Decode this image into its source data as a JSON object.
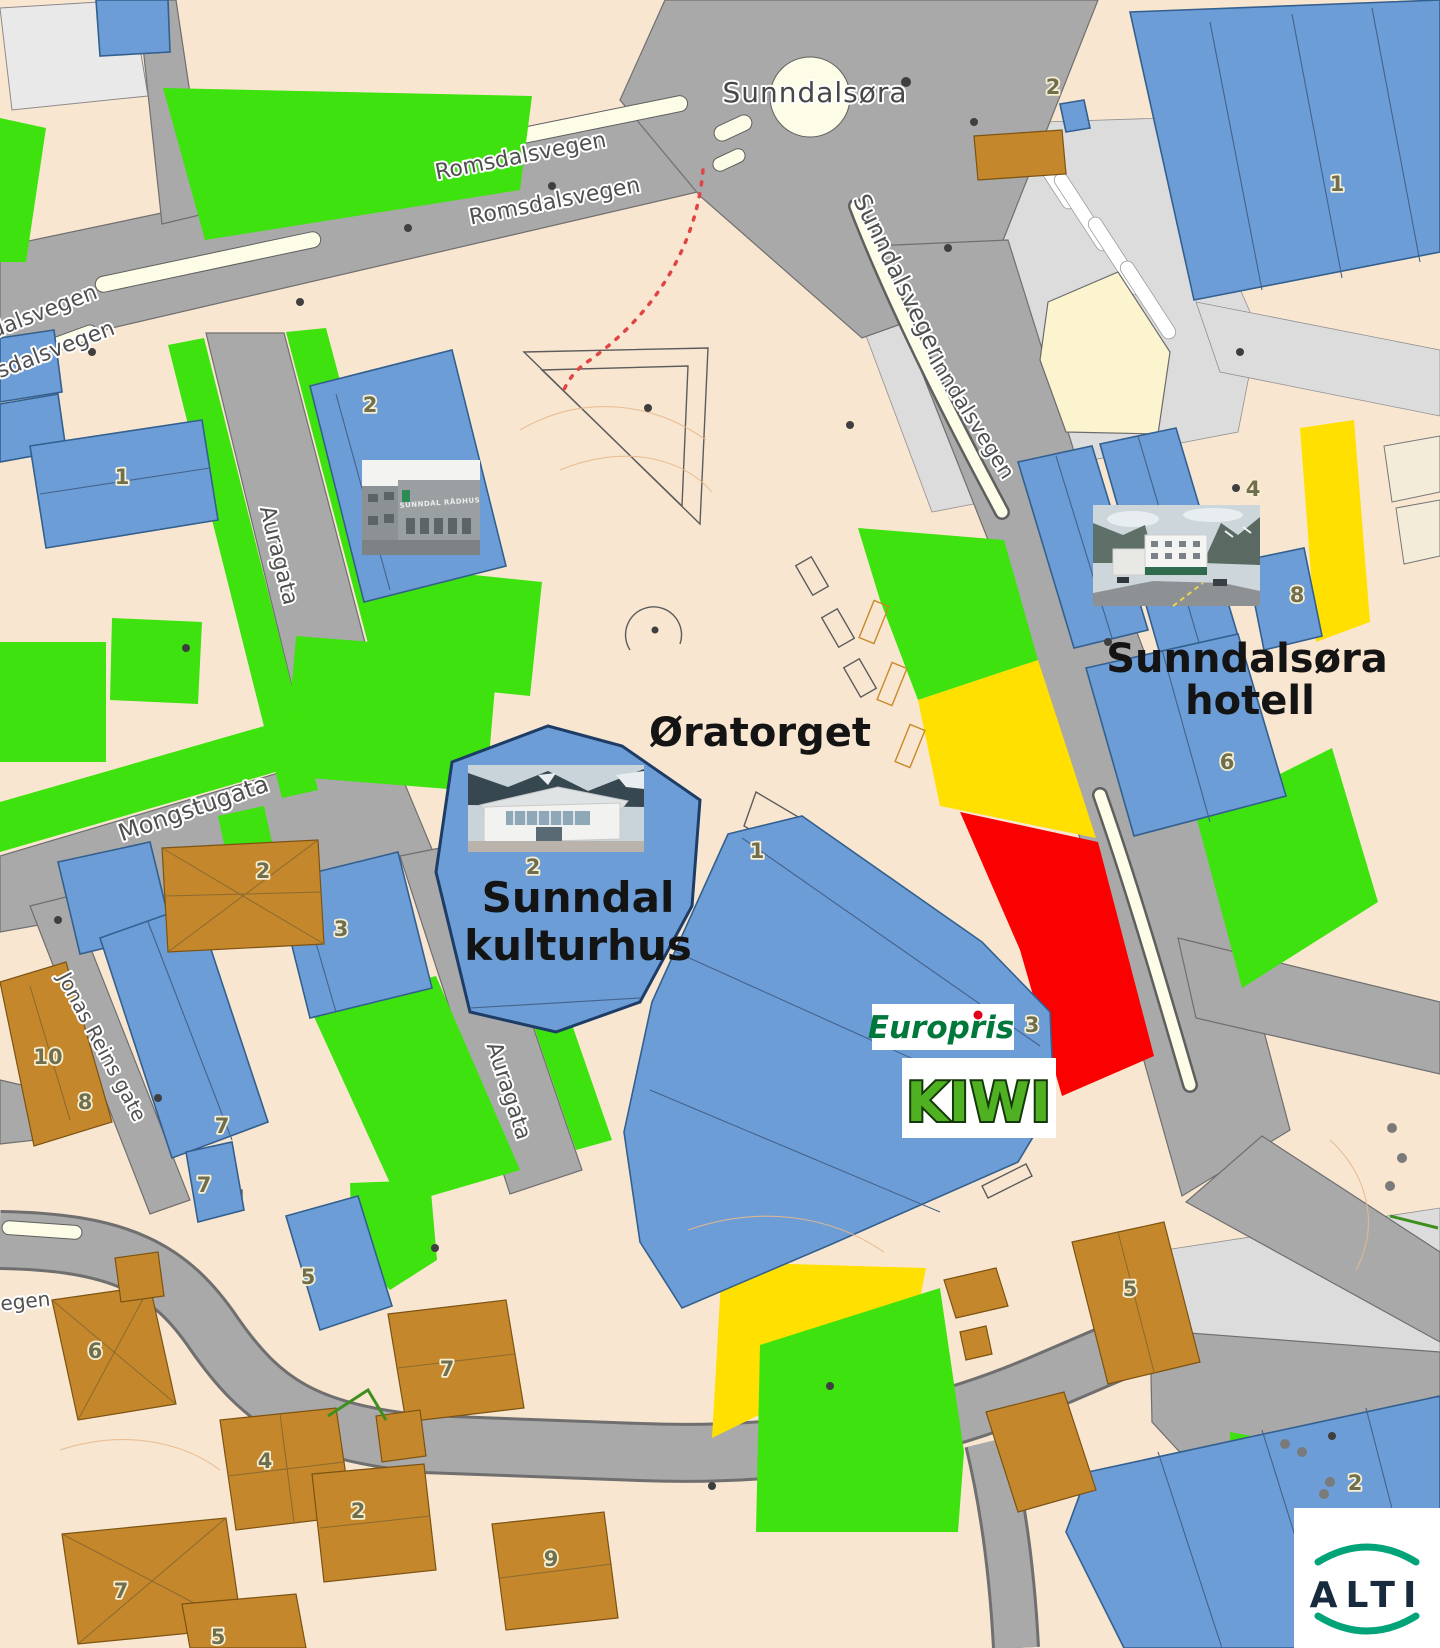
{
  "colors": {
    "land": "#f9e6d1",
    "road": "#a9a9a9",
    "road_light": "#dcdcdc",
    "median": "#fdfce6",
    "building_blue": "#6d9dd6",
    "building_blue_outline": "#33608f",
    "building_tan": "#c5872b",
    "building_pale": "#fbf4cf",
    "zone_green": "#3ee20e",
    "zone_yellow": "#ffe000",
    "zone_red": "#fb0000",
    "europris_green": "#00783b",
    "kiwi_green": "#4fb022",
    "alti_navy": "#182a3d",
    "alti_arc": "#00a478"
  },
  "place": {
    "label": "Sunndalsøra"
  },
  "streets": {
    "romsdalsvegen_a": "Romsdalsvegen",
    "romsdalsvegen_b": "Romsdalsvegen",
    "romsdalsvegen_partial_a": "dalsvegen",
    "romsdalsvegen_partial_b": "sdalsvegen",
    "sunndalsvegen": "Sunndalsvegen",
    "inndalsvegen": "Inndalsvegen",
    "sunndal_radhus": "Sunndal Rådhus",
    "auragata_a": "Auragata",
    "auragata_b": "Auragata",
    "mongstugata": "Mongstugata",
    "jonas_reins_gate": "Jonas Reins gate",
    "vegen_partial": "egen"
  },
  "poi": {
    "oratorget": "Øratorget",
    "kulturhus_line1": "Sunndal",
    "kulturhus_line2": "kulturhus",
    "hotell_line1": "Sunndalsøra",
    "hotell_line2": "hotell"
  },
  "logos": {
    "europris": "Europris",
    "kiwi": "KIWI",
    "alti": "ALTI"
  },
  "photos": {
    "radhus_sign": "SUNNDAL RÅDHUS"
  },
  "numbers": [
    {
      "n": "2"
    },
    {
      "n": "1"
    },
    {
      "n": "2"
    },
    {
      "n": "1"
    },
    {
      "n": "4"
    },
    {
      "n": "8"
    },
    {
      "n": "6"
    },
    {
      "n": "2"
    },
    {
      "n": "1"
    },
    {
      "n": "3"
    },
    {
      "n": "3"
    },
    {
      "n": "2"
    },
    {
      "n": "7"
    },
    {
      "n": "8"
    },
    {
      "n": "10"
    },
    {
      "n": "5"
    },
    {
      "n": "7"
    },
    {
      "n": "6"
    },
    {
      "n": "7"
    },
    {
      "n": "4"
    },
    {
      "n": "2"
    },
    {
      "n": "7"
    },
    {
      "n": "9"
    },
    {
      "n": "5"
    },
    {
      "n": "5"
    },
    {
      "n": "2"
    }
  ]
}
